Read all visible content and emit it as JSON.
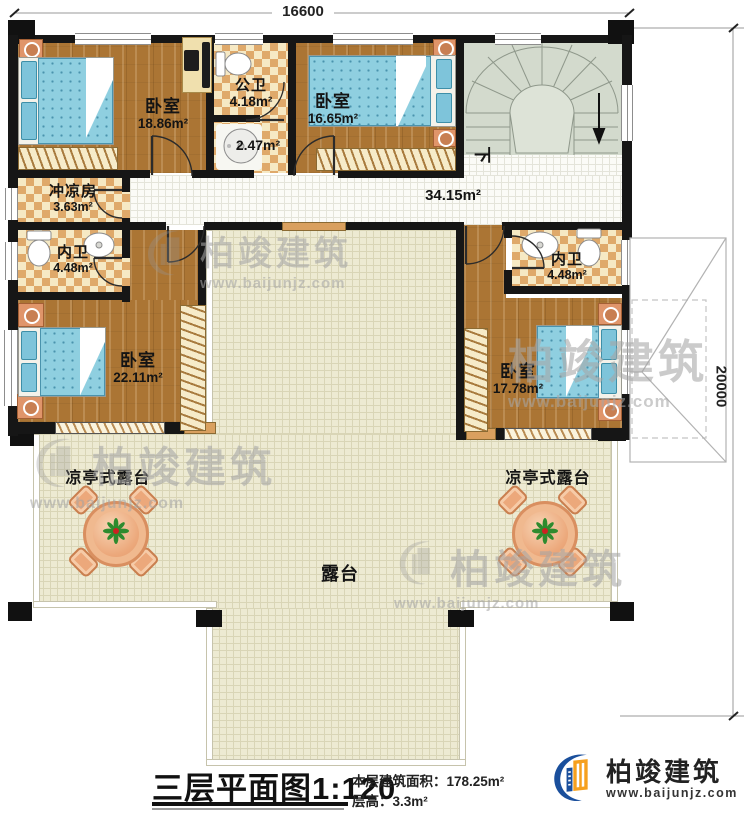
{
  "dimensions": {
    "top_width": "16600",
    "right_height": "20000"
  },
  "rooms": {
    "bedroom_top_left": {
      "name": "卧室",
      "area": "18.86m²"
    },
    "public_bathroom": {
      "name": "公卫",
      "area": "4.18m²"
    },
    "washroom": {
      "area": "2.47m²"
    },
    "bedroom_top_middle": {
      "name": "卧室",
      "area": "16.65m²"
    },
    "shower_room": {
      "name": "冲凉房",
      "area": "3.63m²"
    },
    "ensuite_left": {
      "name": "内卫",
      "area": "4.48m²"
    },
    "ensuite_right": {
      "name": "内卫",
      "area": "4.48m²"
    },
    "bedroom_left": {
      "name": "卧室",
      "area": "22.11m²"
    },
    "bedroom_right": {
      "name": "卧室",
      "area": "17.78m²"
    },
    "hallway": {
      "area": "34.15m²"
    },
    "stairs": {
      "direction_label": "下"
    },
    "pavilion_terrace_left": {
      "name": "凉亭式露台"
    },
    "pavilion_terrace_right": {
      "name": "凉亭式露台"
    },
    "terrace": {
      "name": "露台"
    }
  },
  "title_block": {
    "plan_title": "三层平面图",
    "scale": "1:120",
    "floor_area_label": "本层建筑面积：",
    "floor_area_value": "178.25m²",
    "floor_height_label": "层高：",
    "floor_height_value": "3.3m²"
  },
  "branding": {
    "company": "柏竣建筑",
    "website": "www.baijunjz.com"
  },
  "watermark": {
    "company": "柏竣建筑",
    "website": "www.baijunjz.com"
  },
  "colors": {
    "wall": "#161616",
    "wood": "#ab7534",
    "tile_dark": "#dfa96a",
    "terrace": "#edead2",
    "stair": "#d3dacd",
    "logo_blue": "#1a4f9c",
    "logo_orange": "#f6a01e"
  }
}
